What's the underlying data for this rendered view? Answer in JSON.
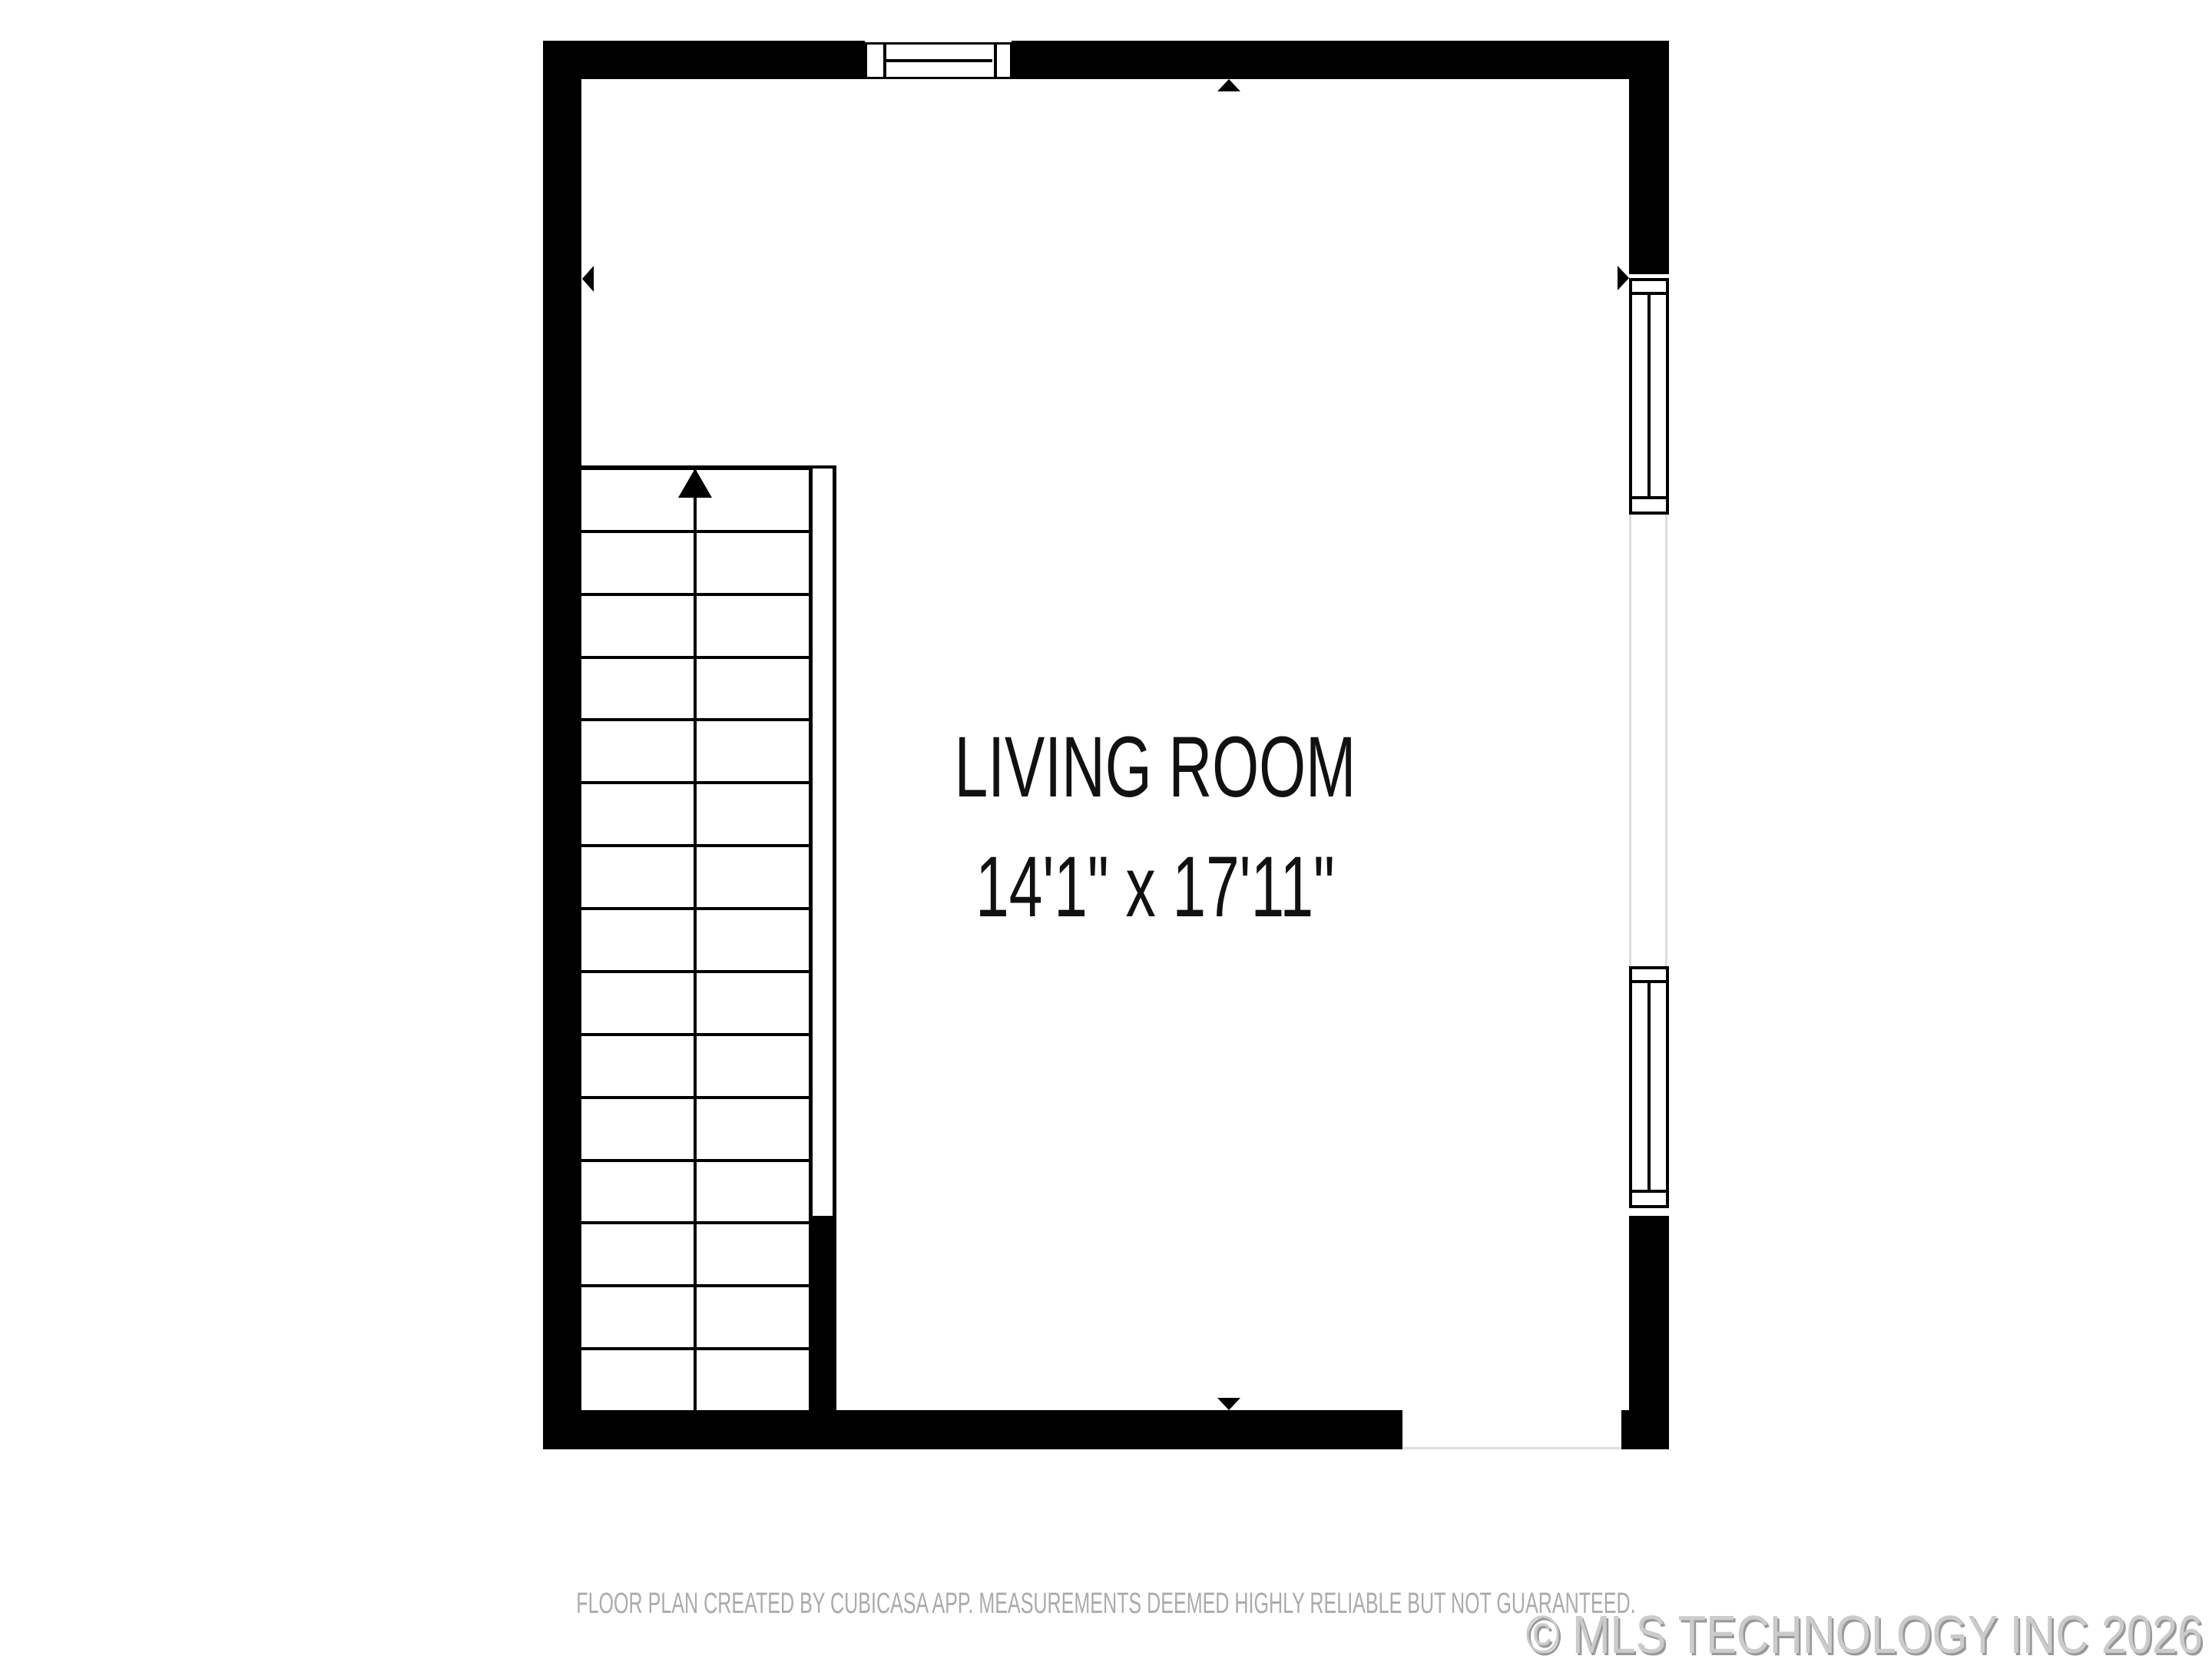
{
  "room": {
    "name": "LIVING ROOM",
    "dimensions": "14'1\" x 17'11\""
  },
  "stairs": {
    "tread_rows": 15,
    "direction": "up"
  },
  "footer": {
    "disclaimer": "FLOOR PLAN CREATED BY CUBICASA APP. MEASUREMENTS DEEMED HIGHLY RELIABLE BUT NOT GUARANTEED.",
    "copyright": "© MLS TECHNOLOGY INC 2026"
  },
  "colors": {
    "background": "#ffffff",
    "wall": "#000000",
    "opening_line": "#dedede",
    "room_label": "#111111",
    "disclaimer_text": "#ababab",
    "watermark_text": "#cbcbcb",
    "watermark_shadow": "#989898"
  }
}
